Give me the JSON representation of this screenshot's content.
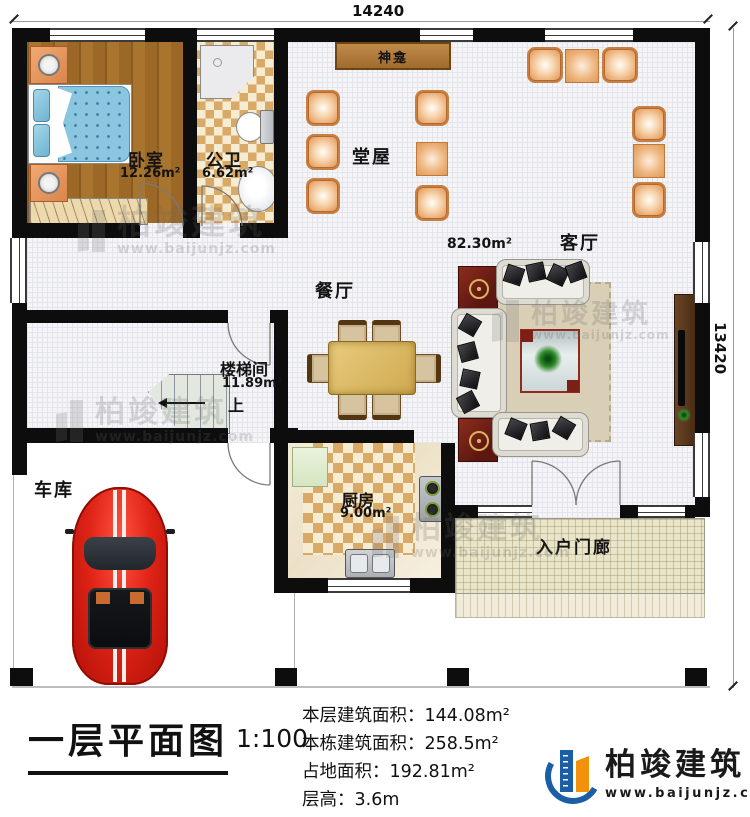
{
  "dims": {
    "width": "14240",
    "height": "13420"
  },
  "rooms": {
    "bedroom": {
      "name": "卧室",
      "area": "12.26m²"
    },
    "bathroom": {
      "name": "公卫",
      "area": "6.62m²"
    },
    "shrine": {
      "name": "神龛"
    },
    "hall": {
      "name": "堂屋"
    },
    "living": {
      "name": "客厅",
      "area": "82.30m²"
    },
    "dining": {
      "name": "餐厅"
    },
    "stairwell": {
      "name": "楼梯间",
      "area": "11.89m²",
      "up": "上"
    },
    "garage": {
      "name": "车库"
    },
    "kitchen": {
      "name": "厨房",
      "area": "9.00m²"
    },
    "porch": {
      "name": "入户门廊"
    }
  },
  "titleblock": {
    "title": "一层平面图",
    "scale": "1:100",
    "stats": [
      {
        "label": "本层建筑面积：",
        "value": "144.08m²"
      },
      {
        "label": "本栋建筑面积：",
        "value": "258.5m²"
      },
      {
        "label": "占地面积：",
        "value": "192.81m²"
      },
      {
        "label": "层高：",
        "value": "3.6m"
      }
    ]
  },
  "brand": {
    "name": "柏竣建筑",
    "url": "www.baijunjz.com"
  },
  "colors": {
    "brand_blue": "#1b5ea6",
    "brand_orange": "#f2920a",
    "wall": "#0d0d0d",
    "chair_orange": "#e8a468"
  }
}
